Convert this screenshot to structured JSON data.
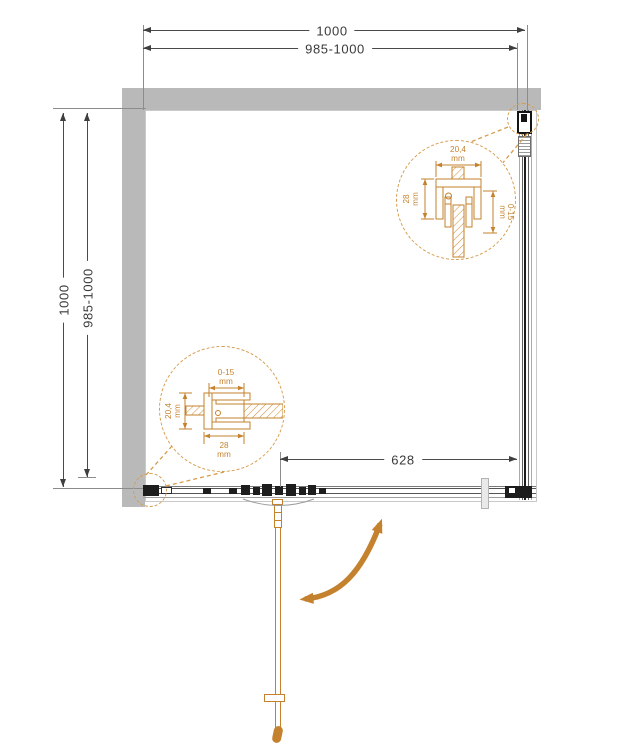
{
  "drawing": {
    "dim_width_outer": "1000",
    "dim_width_inner": "985-1000",
    "dim_height_outer": "1000",
    "dim_height_inner": "985-1000",
    "dim_door_opening": "628"
  },
  "detail_top_right": {
    "dim_top_value": "20,4",
    "dim_top_unit": "mm",
    "dim_left_value": "28",
    "dim_left_unit": "mm",
    "dim_right_value": "0-15",
    "dim_right_unit": "mm"
  },
  "detail_bottom_left": {
    "dim_top_value": "0-15",
    "dim_top_unit": "mm",
    "dim_left_value": "20,4",
    "dim_left_unit": "mm",
    "dim_bottom_value": "28",
    "dim_bottom_unit": "mm"
  },
  "icons": {
    "swing_arrow": "door-swing-direction",
    "detail_callout": "magnified-profile-detail"
  },
  "colors": {
    "accent_orange": "#C5822E",
    "detail_dash_orange": "#D79C4E",
    "wall_gray": "#B9B9B9",
    "line_dark": "#3F3F3F"
  }
}
